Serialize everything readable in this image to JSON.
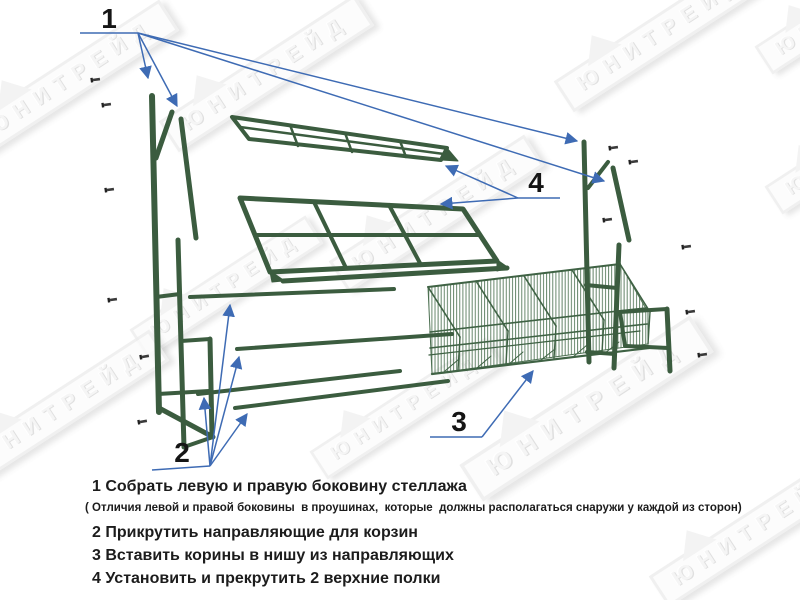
{
  "watermark": {
    "text": "ЮНИТРЕЙД"
  },
  "callouts": {
    "c1": "1",
    "c2": "2",
    "c3": "3",
    "c4": "4"
  },
  "instructions": {
    "step1": "1 Собрать левую и правую боковину стеллажа",
    "step1_note": "( Отличия левой и правой боковины  в проушинах,  которые  должны располагаться снаружи у каждой из сторон)",
    "step2": "2 Прикрутить направляющие для корзин",
    "step3": "3 Вставить корины в нишу из направляющих",
    "step4": "4 Установить и прекрутить 2 верхние полки"
  },
  "colors": {
    "structure_green": "#3b5c3f",
    "mesh_green": "#56795b",
    "callout_blue": "#3e6bb4",
    "text_black": "#1c1c1c",
    "watermark_gray": "#ececec"
  }
}
